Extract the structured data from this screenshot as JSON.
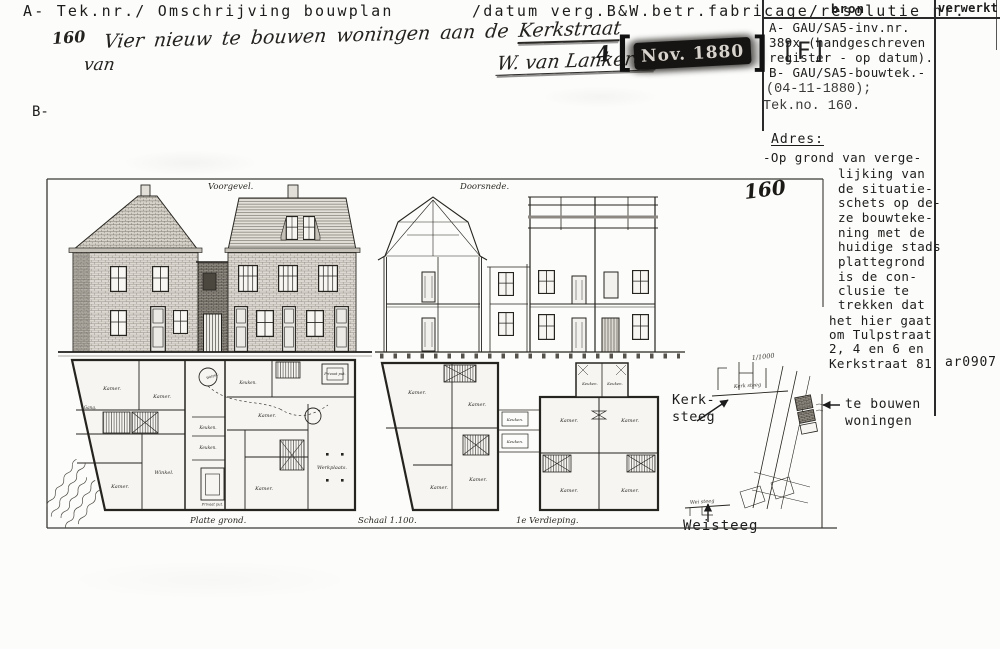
{
  "header": {
    "left": "A- Tek.nr./ Omschrijving bouwplan",
    "right": "/datum verg.B&W.betr.fabricage/resolutie nr.",
    "b_label": "B-"
  },
  "columns": {
    "bron_header": "bron",
    "verwerkt_header": "verwerkt",
    "bron_lines": [
      "A- GAU/SA5-inv.nr.",
      "389x (handgeschreven",
      "register - op datum).",
      "B- GAU/SA5-bouwtek.-"
    ],
    "bron_lines_alt": [
      "(04-11-1880);",
      "Tek.no. 160."
    ],
    "ref_code": "ar0907"
  },
  "adres": {
    "heading": "Adres:",
    "first_line": "-Op grond van verge-",
    "indented_lines": [
      "lijking van",
      "de situatie-",
      "schets op de-",
      "ze bouwteke-",
      "ning met de",
      "huidige stads",
      "plattegrond",
      "is de con-",
      "clusie te",
      "trekken dat"
    ],
    "final_lines": [
      "het hier gaat",
      "om Tulpstraat",
      "2, 4 en 6 en",
      "Kerkstraat 81"
    ]
  },
  "handwritten": {
    "number": "160",
    "title": "Vier nieuw te bouwen woningen aan de ",
    "title_street": "Kerkstraat",
    "van": "van",
    "signature": "W. van Lankeren",
    "stamp_day": "4",
    "stamp_text": "Nov. 1880",
    "stamp_mark": "[F]",
    "drawing_number": "160"
  },
  "annotations": {
    "te_bouwen_line1": "te bouwen",
    "te_bouwen_line2": "woningen",
    "kerksteeg_line1": "Kerk-",
    "kerksteeg_line2": "steeg",
    "weisteeg": "Weisteeg"
  },
  "drawing": {
    "voorgevel": "Voorgevel.",
    "doorsnede": "Doorsnede.",
    "plattegrond": "Platte grond.",
    "schaal": "Schaal 1.100.",
    "verdieping": "1e Verdieping.",
    "kerk_steeg": "Kerk steeg",
    "wei_steeg": "Wei steeg",
    "site_scale": "1/1000",
    "rooms": {
      "kamer": "Kamer.",
      "winkel": "Winkel.",
      "keuken": "Keuken.",
      "werkplaats": "Werkplaats.",
      "gang": "Gang.",
      "privaat": "Privaat put.",
      "welput": "Welput."
    }
  }
}
